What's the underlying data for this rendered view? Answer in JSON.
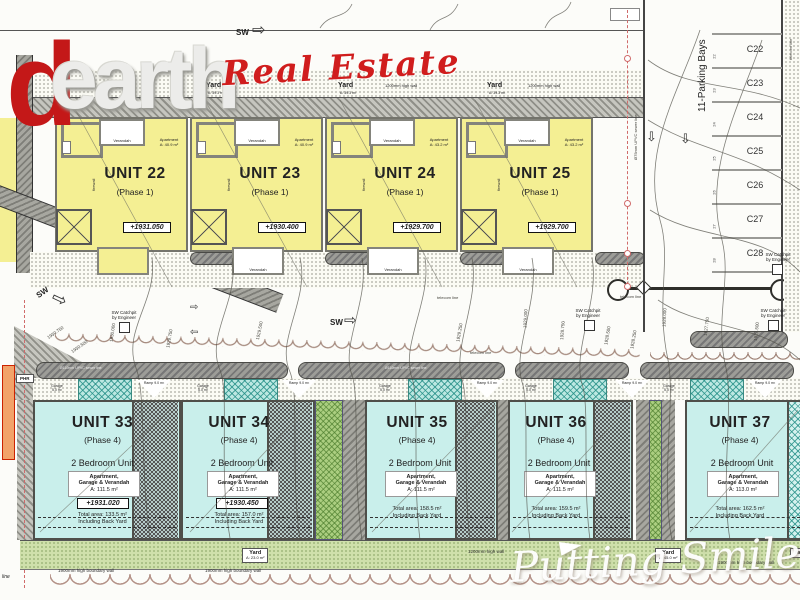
{
  "branding": {
    "logo_d": "d",
    "logo_rest": "earth",
    "tagline": "Real Estate",
    "watermark": "Putting Smiles on F"
  },
  "top": {
    "sw": "SW",
    "yard": "Yard",
    "yard_area": "A: 39.3 m²",
    "wall": "1200mm high wall"
  },
  "phase1_units": [
    {
      "name": "UNIT 22",
      "phase": "(Phase 1)",
      "level": "+1931.050",
      "apartment": "Apartment",
      "apartment_area": "A: 40.9 m²",
      "verandah": "Verandah",
      "firewall": "firewall"
    },
    {
      "name": "UNIT 23",
      "phase": "(Phase 1)",
      "level": "+1930.400",
      "apartment": "Apartment",
      "apartment_area": "A: 40.9 m²",
      "verandah": "Verandah",
      "firewall": "firewall"
    },
    {
      "name": "UNIT 24",
      "phase": "(Phase 1)",
      "level": "+1929.700",
      "apartment": "Apartment",
      "apartment_area": "A: 43.2 m²",
      "verandah": "Verandah",
      "firewall": "firewall"
    },
    {
      "name": "UNIT 25",
      "phase": "(Phase 1)",
      "level": "+1929.700",
      "apartment": "Apartment",
      "apartment_area": "A: 43.2 m²",
      "verandah": "Verandah",
      "firewall": "firewall"
    }
  ],
  "phase4_units": [
    {
      "name": "UNIT 33",
      "phase": "(Phase 4)",
      "type": "2 Bedroom Unit",
      "comp1": "Apartment,",
      "comp2": "Garage & Verandah",
      "area": "A: 111.5 m²",
      "level": "+1931.020",
      "total": "Total area: 133.5 m²",
      "note": "Including Back Yard"
    },
    {
      "name": "UNIT 34",
      "phase": "(Phase 4)",
      "type": "2 Bedroom Unit",
      "comp1": "Apartment,",
      "comp2": "Garage & Verandah",
      "area": "A: 111.5 m²",
      "level": "+1930.450",
      "total": "Total area: 157.0 m²",
      "note": "Including Back Yard"
    },
    {
      "name": "UNIT 35",
      "phase": "(Phase 4)",
      "type": "2 Bedroom Unit",
      "comp1": "Apartment,",
      "comp2": "Garage & Verandah",
      "area": "A: 111.5 m²",
      "total": "Total area: 158.5 m²",
      "note": "Including Back Yard"
    },
    {
      "name": "UNIT 36",
      "phase": "(Phase 4)",
      "type": "2 Bedroom Unit",
      "comp1": "Apartment,",
      "comp2": "Garage & Verandah",
      "area": "A: 111.5 m²",
      "total": "Total area: 159.5 m²",
      "note": "Including Back Yard"
    },
    {
      "name": "UNIT 37",
      "phase": "(Phase 4)",
      "type": "2 Bedroom Unit",
      "comp1": "Apartment,",
      "comp2": "Garage & Verandah",
      "area": "A: 113.0 m²",
      "total": "Total area: 162.5 m²",
      "note": "Including Back Yard"
    }
  ],
  "parking": {
    "title": "11-Parking Bays",
    "bays": [
      "C22",
      "C23",
      "C24",
      "C25",
      "C26",
      "C27",
      "C28"
    ],
    "numbers": [
      "22",
      "23",
      "24",
      "25",
      "26",
      "27",
      "28"
    ]
  },
  "annotations": {
    "sw": "SW",
    "catchpit1": "SW Catchpit",
    "catchpit2": "by Engineer",
    "telecom": "telecom line",
    "sewer_note": "Ø110mm UPVC sewer line",
    "sewer_vert": "Ø75mm UPVC sewer line",
    "ramp": "Ramp",
    "ramp_area": "9.0 m²",
    "garage": "Garage",
    "garage_area": "5.0 m²",
    "phr": "PHR",
    "line_partial": "line",
    "contours_road": [
      "1930.750",
      "1930.500"
    ],
    "contours_mid": [
      "1930.000",
      "1929.750",
      "1929.500",
      "1929.250",
      "1929.000",
      "1928.750",
      "1928.500",
      "1928.250",
      "1928.000",
      "1927.750",
      "1927.500"
    ]
  },
  "bottom": {
    "yard": "Yard",
    "yard_area1": "A: 23.0 m²",
    "yard_area2": "A: 45.0 m²",
    "wall": "1200mm high wall",
    "boundary": "1900mm high boundary wall"
  }
}
